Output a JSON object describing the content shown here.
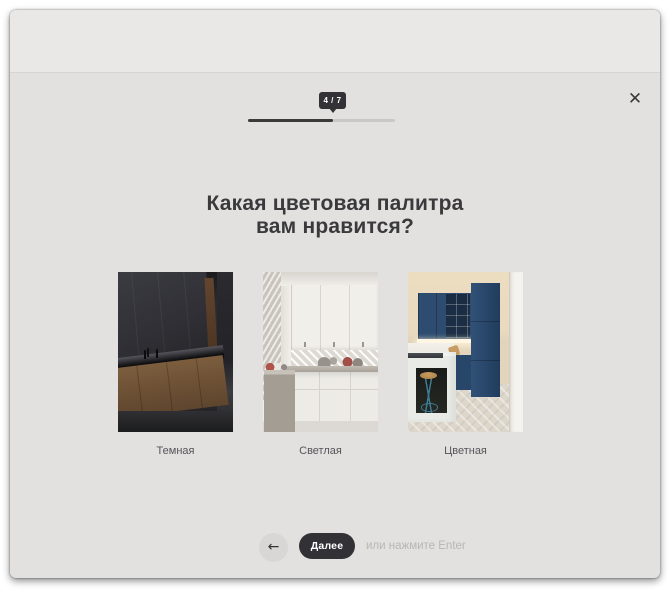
{
  "icons": {
    "close": "✕",
    "back": "←"
  },
  "progress": {
    "current": 4,
    "total": 7,
    "label": "4 / 7",
    "done_color": "#3a3a3a",
    "rest_color": "#c9c8c6"
  },
  "question": {
    "title_line1": "Какая цветовая палитра",
    "title_line2": "вам нравится?"
  },
  "options": [
    {
      "label": "Темная",
      "image": "dark-kitchen-photo"
    },
    {
      "label": "Светлая",
      "image": "light-kitchen-photo"
    },
    {
      "label": "Цветная",
      "image": "colorful-kitchen-photo"
    }
  ],
  "footer": {
    "next_label": "Далее",
    "hint": "или нажмите Enter"
  },
  "colors": {
    "accent_dark": "#323135",
    "modal_bg": "#e2e1df",
    "header_bg": "#e9e8e6"
  }
}
